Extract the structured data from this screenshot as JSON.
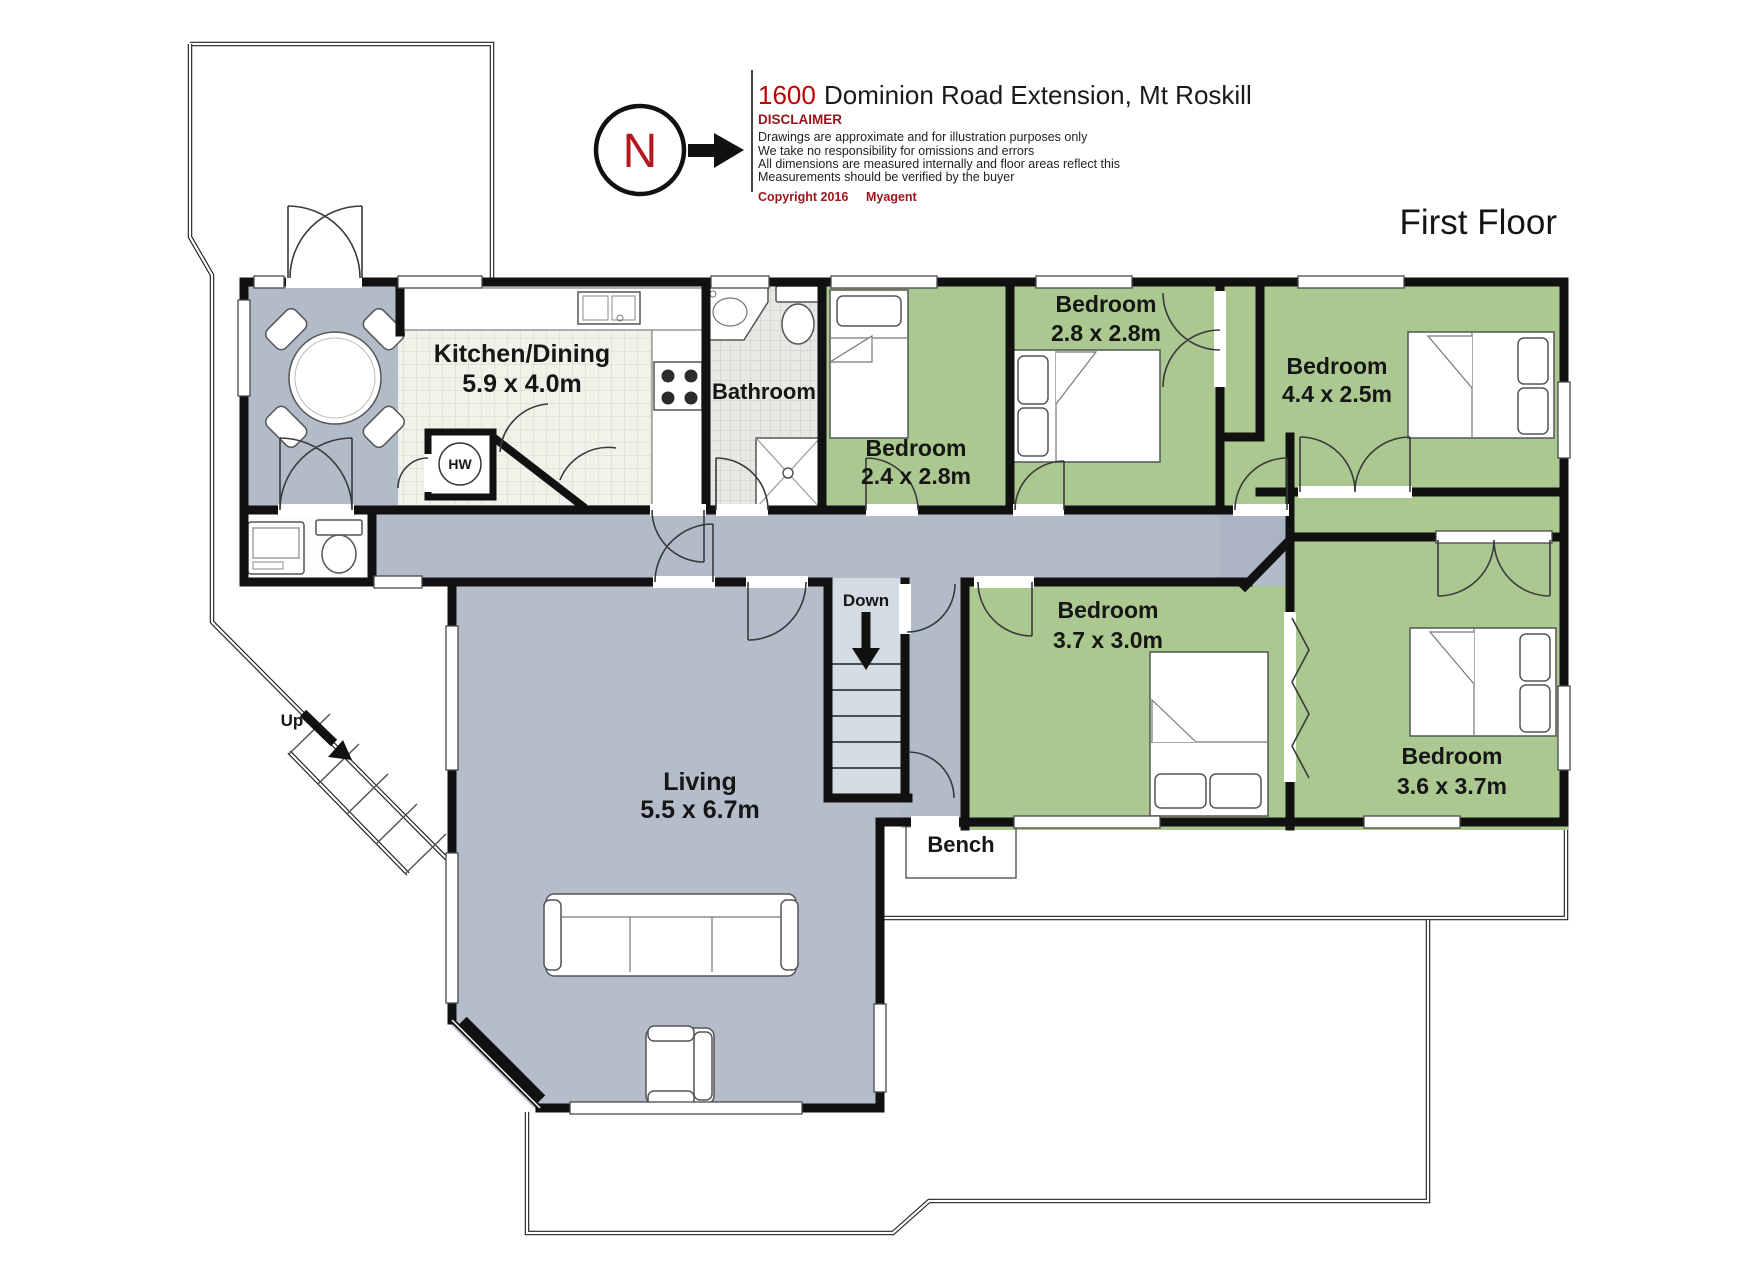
{
  "header": {
    "compass_letter": "N",
    "address_number": "1600",
    "address_rest": "Dominion Road Extension, Mt Roskill",
    "disclaimer_title": "DISCLAIMER",
    "disclaimer_lines": [
      "Drawings are approximate and for illustration purposes only",
      "We take no responsibility for omissions and errors",
      "All dimensions are measured internally and floor areas reflect this",
      "Measurements should be verified by the buyer"
    ],
    "copyright": "Copyright 2016",
    "copyright_agent": "Myagent"
  },
  "floor_label": "First Floor",
  "rooms": {
    "kitchen_dining": {
      "name": "Kitchen/Dining",
      "dims": "5.9 x 4.0m"
    },
    "bathroom": {
      "name": "Bathroom"
    },
    "bedroom_24": {
      "name": "Bedroom",
      "dims": "2.4 x 2.8m"
    },
    "bedroom_28": {
      "name": "Bedroom",
      "dims": "2.8 x 2.8m"
    },
    "bedroom_44": {
      "name": "Bedroom",
      "dims": "4.4 x 2.5m"
    },
    "bedroom_37": {
      "name": "Bedroom",
      "dims": "3.7 x 3.0m"
    },
    "bedroom_36": {
      "name": "Bedroom",
      "dims": "3.6 x 3.7m"
    },
    "living": {
      "name": "Living",
      "dims": "5.5 x 6.7m"
    }
  },
  "annotations": {
    "down": "Down",
    "up": "Up",
    "bench": "Bench",
    "hot_water": "HW"
  },
  "colors": {
    "bedroom_green": "#aac88f",
    "floor_gray": "#b2bbc8",
    "stair_gray": "#d4dbe3",
    "wall_black": "#111111",
    "accent_red": "#c00000",
    "heading_maroon": "#9a1519"
  }
}
